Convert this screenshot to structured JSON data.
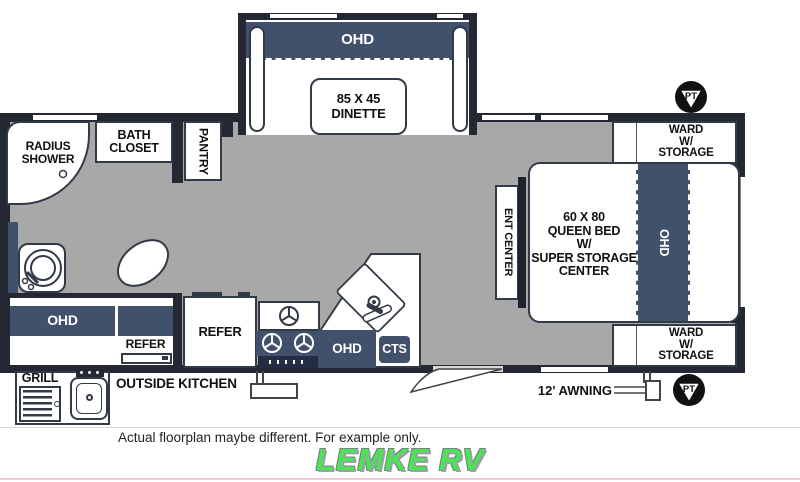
{
  "slide": {
    "ohd": "OHD",
    "dinette_l1": "85 X 45",
    "dinette_l2": "DINETTE"
  },
  "bath": {
    "shower_l1": "RADIUS",
    "shower_l2": "SHOWER",
    "closet_l1": "BATH",
    "closet_l2": "CLOSET",
    "pantry": "PANTRY"
  },
  "storage": {
    "ohd": "OHD",
    "refer": "REFER"
  },
  "kitchen": {
    "refer": "REFER",
    "ohd": "OHD",
    "cts": "CTS"
  },
  "bedroom": {
    "ent_center": "ENT CENTER",
    "bed_l1": "60 X 80",
    "bed_l2": "QUEEN BED",
    "bed_l3": "W/",
    "bed_l4": "SUPER STORAGE",
    "bed_l5": "CENTER",
    "ohd": "OHD",
    "ward_l1": "WARD",
    "ward_l2": "W/",
    "ward_l3": "STORAGE"
  },
  "outside": {
    "grill": "GRILL",
    "kitchen_label": "OUTSIDE KITCHEN",
    "awning": "12' AWNING",
    "pt": "PT"
  },
  "footer": {
    "disclaimer": "Actual floorplan maybe different. For example only.",
    "dealer": "LEMKE RV"
  },
  "colors": {
    "wall": "#232833",
    "furniture_navy": "#41506b",
    "vent_navy": "#222c42",
    "floor_gray": "#a8a8a8",
    "logo_green": "#4ce455",
    "bottom_line_pink": "#f0ccd4"
  }
}
